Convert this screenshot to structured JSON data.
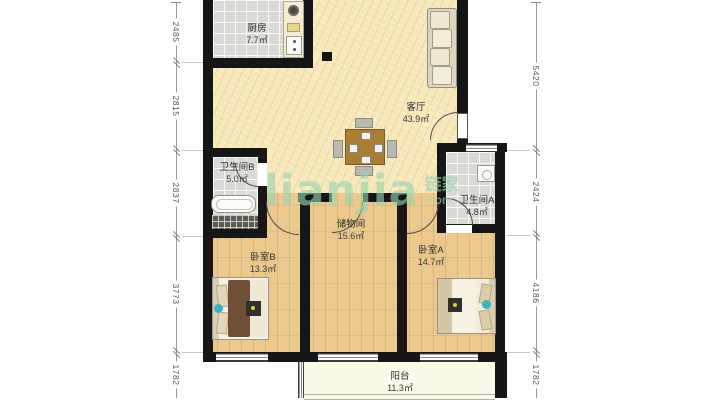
{
  "floorplan": {
    "rooms": [
      {
        "name": "厨房",
        "area": "7.7㎡"
      },
      {
        "name": "客厅",
        "area": "43.9㎡"
      },
      {
        "name": "卫生间B",
        "area": "5.0㎡"
      },
      {
        "name": "卫生间A",
        "area": "4.8㎡"
      },
      {
        "name": "储物间",
        "area": "15.6㎡"
      },
      {
        "name": "卧室B",
        "area": "13.3㎡"
      },
      {
        "name": "卧室A",
        "area": "14.7㎡"
      },
      {
        "name": "阳台",
        "area": "11.3㎡"
      }
    ],
    "dimensions_mm": {
      "left": [
        "2485",
        "2815",
        "2837",
        "3773",
        "1782"
      ],
      "right": [
        "5420",
        "2424",
        "4186",
        "1782"
      ]
    },
    "watermark": {
      "brand": "lianjia",
      "brand_cn": "链家",
      "domain_suffix": ".com"
    },
    "colors": {
      "wall": "#161616",
      "living_floor": "#f6e8bb",
      "wood_floor": "#eac88e",
      "tile_floor": "#d9d9d5",
      "balcony_floor": "#fdf9ea",
      "watermark_green": "#97d3b1"
    }
  }
}
